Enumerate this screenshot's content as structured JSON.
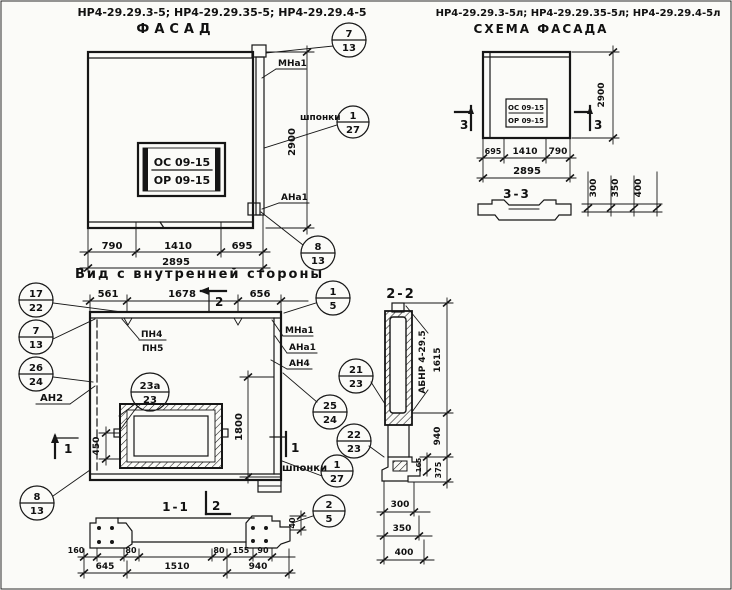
{
  "facade": {
    "codes": "НР4-29.29.3-5; НР4-29.29.35-5; НР4-29.29.4-5",
    "title": "ФАСАД",
    "stamp": {
      "top": "ОС 09-15",
      "bottom": "ОР 09-15"
    },
    "labels": {
      "mna1": "МНа1",
      "shponki": "шпонки",
      "ana1": "АНа1"
    },
    "dim_height": "2900",
    "dims_bottom": [
      "790",
      "1410",
      "695"
    ],
    "dim_total": "2895",
    "callouts": {
      "top": {
        "n": "7",
        "s": "13"
      },
      "keys": {
        "n": "1",
        "s": "27"
      },
      "bottom": {
        "n": "8",
        "s": "13"
      }
    }
  },
  "schema": {
    "codes": "НР4-29.29.3-5л; НР4-29.29.35-5л; НР4-29.29.4-5л",
    "title": "Схема фасада",
    "stamp": {
      "top": "ОС 09-15",
      "bottom": "ОР 09-15"
    },
    "marker": "3",
    "dim_height": "2900",
    "dims_bottom": [
      "695",
      "1410",
      "790"
    ],
    "dim_total": "2895",
    "section": {
      "title": "3-3",
      "dims": [
        "300",
        "350",
        "400"
      ]
    }
  },
  "inner": {
    "title": "Вид с внутренней стороны",
    "dims_top": [
      "561",
      "1678",
      "656"
    ],
    "marker_top": "2",
    "marker_side": "1",
    "marker_bottom": "2",
    "labels": {
      "pn4": "ПН4",
      "pn5": "ПН5",
      "mna1": "МНа1",
      "ana1": "АНа1",
      "an4": "АН4",
      "an2": "АН2",
      "shponki": "шпонки"
    },
    "dim_450": "450",
    "dim_1800": "1800",
    "dim_40": "40",
    "section_title": "1-1",
    "dims_small": [
      "160",
      "80",
      "80",
      "155",
      "90"
    ],
    "dims_bottom": [
      "645",
      "1510",
      "940"
    ],
    "callouts": {
      "c17_22": {
        "n": "17",
        "s": "22"
      },
      "c7_13": {
        "n": "7",
        "s": "13"
      },
      "c26_24": {
        "n": "26",
        "s": "24"
      },
      "c1_5": {
        "n": "1",
        "s": "5"
      },
      "c21_23": {
        "n": "21",
        "s": "23"
      },
      "c25_24": {
        "n": "25",
        "s": "24"
      },
      "c22_23": {
        "n": "22",
        "s": "23"
      },
      "c1_27": {
        "n": "1",
        "s": "27"
      },
      "c23a_23": {
        "n": "23а",
        "s": "23"
      },
      "c8_13": {
        "n": "8",
        "s": "13"
      },
      "c2_5": {
        "n": "2",
        "s": "5"
      }
    }
  },
  "section22": {
    "title": "2-2",
    "label": "АБНР 4-29.5",
    "dim_1615": "1615",
    "dim_940": "940",
    "dim_165": "165",
    "dim_375": "375",
    "dims_bottom": [
      "300",
      "350",
      "400"
    ]
  }
}
